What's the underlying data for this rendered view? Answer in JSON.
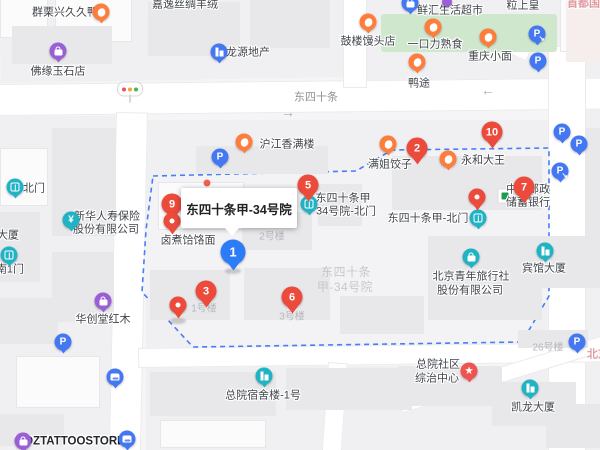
{
  "map": {
    "selected_place": "东四十条甲-34号院",
    "road_label": "东四十条",
    "colors": {
      "boundary": "#4a7cf7",
      "red_pin": "#ec4a3b",
      "blue_pin": "#2d7cf7",
      "teal_marker": "#20b3c4",
      "orange_marker": "#fd7e3c",
      "purple_marker": "#9a5fd5",
      "blue_marker": "#4478f2",
      "postal_green": "#1c9c50",
      "park_green": "#cfe8cd"
    },
    "texts": [
      {
        "t": "群栗兴久久鸭",
        "x": 65,
        "y": 13,
        "c": "poi"
      },
      {
        "t": "嘉逸丝绸羊绒",
        "x": 185,
        "y": 5,
        "c": "poi"
      },
      {
        "t": "佛缘玉石店",
        "x": 58,
        "y": 72,
        "c": "poi"
      },
      {
        "t": "龙源地产",
        "x": 248,
        "y": 53,
        "c": "poi"
      },
      {
        "t": "鲜汇生活超市",
        "x": 450,
        "y": 11,
        "c": "poi"
      },
      {
        "t": "粒上皇",
        "x": 523,
        "y": 6,
        "c": "poi"
      },
      {
        "t": "首都国医",
        "x": 589,
        "y": 4,
        "c": "pink"
      },
      {
        "t": "鼓楼馒头店",
        "x": 368,
        "y": 42,
        "c": "poi"
      },
      {
        "t": "一口力熟食",
        "x": 435,
        "y": 45,
        "c": "poi"
      },
      {
        "t": "重庆小面",
        "x": 490,
        "y": 57,
        "c": "poi"
      },
      {
        "t": "鸭途",
        "x": 419,
        "y": 84,
        "c": "poi"
      },
      {
        "t": "东四十条",
        "x": 316,
        "y": 98,
        "c": "road-name"
      },
      {
        "t": "→",
        "x": 288,
        "y": 112,
        "c": "arrow"
      },
      {
        "t": "←",
        "x": 488,
        "y": 90,
        "c": "arrow"
      },
      {
        "t": "沪江香满楼",
        "x": 287,
        "y": 145,
        "c": "poi"
      },
      {
        "t": "满姐饺子",
        "x": 390,
        "y": 165,
        "c": "poi"
      },
      {
        "t": "永和大王",
        "x": 483,
        "y": 161,
        "c": "poi"
      },
      {
        "t": "中国邮政",
        "x": 528,
        "y": 190,
        "c": "poi"
      },
      {
        "t": "储蓄银行",
        "x": 528,
        "y": 203,
        "c": "poi"
      },
      {
        "t": "东四十条甲",
        "x": 343,
        "y": 199,
        "c": "poi"
      },
      {
        "t": "34号院-北门",
        "x": 346,
        "y": 212,
        "c": "poi"
      },
      {
        "t": "东四十条甲-北门",
        "x": 428,
        "y": 219,
        "c": "poi"
      },
      {
        "t": "北门",
        "x": 34,
        "y": 189,
        "c": "poi"
      },
      {
        "t": "新华人寿保险",
        "x": 107,
        "y": 217,
        "c": "poi"
      },
      {
        "t": "股份有限公司",
        "x": 106,
        "y": 230,
        "c": "poi"
      },
      {
        "t": "大厦",
        "x": 8,
        "y": 236,
        "c": "poi"
      },
      {
        "t": "南1门",
        "x": 10,
        "y": 270,
        "c": "poi"
      },
      {
        "t": "卤煮饸饹面",
        "x": 188,
        "y": 241,
        "c": "poi"
      },
      {
        "t": "2号楼",
        "x": 272,
        "y": 237,
        "c": "bldg"
      },
      {
        "t": "东四十条",
        "x": 346,
        "y": 273,
        "c": "area"
      },
      {
        "t": "甲-34号院",
        "x": 345,
        "y": 288,
        "c": "area"
      },
      {
        "t": "1号楼",
        "x": 204,
        "y": 309,
        "c": "bldg"
      },
      {
        "t": "3号楼",
        "x": 292,
        "y": 317,
        "c": "bldg"
      },
      {
        "t": "北京青年旅行社",
        "x": 471,
        "y": 277,
        "c": "poi"
      },
      {
        "t": "股份有限公司",
        "x": 470,
        "y": 291,
        "c": "poi"
      },
      {
        "t": "宾馆大厦",
        "x": 544,
        "y": 269,
        "c": "poi"
      },
      {
        "t": "26号楼",
        "x": 548,
        "y": 348,
        "c": "bldg"
      },
      {
        "t": "北京",
        "x": 598,
        "y": 355,
        "c": "pink"
      },
      {
        "t": "华创堂红木",
        "x": 103,
        "y": 320,
        "c": "poi"
      },
      {
        "t": "总院宿舍楼-1号",
        "x": 263,
        "y": 396,
        "c": "poi"
      },
      {
        "t": "总院社区",
        "x": 438,
        "y": 365,
        "c": "poi"
      },
      {
        "t": "综治中心",
        "x": 437,
        "y": 379,
        "c": "poi"
      },
      {
        "t": "凯龙大厦",
        "x": 533,
        "y": 408,
        "c": "poi"
      },
      {
        "t": "MDZTATTOOSTORE",
        "x": 70,
        "y": 442,
        "c": "poi-bold"
      }
    ],
    "markers": [
      {
        "name": "food-marker-qunlixing",
        "type": "food",
        "x": 101,
        "y": 12
      },
      {
        "name": "shopping-marker-foyuan",
        "type": "shopping",
        "x": 58,
        "y": 51
      },
      {
        "name": "traffic-light-marker",
        "type": "traffic",
        "x": 130,
        "y": 89
      },
      {
        "name": "company-marker-longyuan",
        "type": "building-blue",
        "x": 219,
        "y": 52
      },
      {
        "name": "supermarket-marker-xianhui",
        "type": "bag-blue",
        "x": 410,
        "y": 3
      },
      {
        "name": "shopping-marker-top-edge",
        "type": "shopping-small",
        "x": 447,
        "y": 2
      },
      {
        "name": "food-marker-gulou",
        "type": "food",
        "x": 368,
        "y": 22
      },
      {
        "name": "food-marker-yikouli",
        "type": "food",
        "x": 433,
        "y": 27
      },
      {
        "name": "food-marker-chongqing",
        "type": "food",
        "x": 488,
        "y": 37
      },
      {
        "name": "food-marker-yatu",
        "type": "food",
        "x": 417,
        "y": 62
      },
      {
        "name": "parking-entrance-marker-1",
        "type": "parking-entrance",
        "x": 537,
        "y": 34
      },
      {
        "name": "parking-marker-1",
        "type": "parking",
        "x": 538,
        "y": 61
      },
      {
        "name": "food-marker-hujiang",
        "type": "food",
        "x": 244,
        "y": 142
      },
      {
        "name": "parking-marker-2",
        "type": "parking",
        "x": 220,
        "y": 157
      },
      {
        "name": "result-pin-2",
        "type": "red-pin",
        "n": "2",
        "x": 417,
        "y": 148
      },
      {
        "name": "food-marker-manjie",
        "type": "food",
        "x": 388,
        "y": 144
      },
      {
        "name": "food-marker-yonghe",
        "type": "food",
        "x": 448,
        "y": 159
      },
      {
        "name": "result-pin-10",
        "type": "red-pin",
        "n": "10",
        "x": 492,
        "y": 132
      },
      {
        "name": "parking-marker-3",
        "type": "parking",
        "x": 562,
        "y": 132
      },
      {
        "name": "parking-marker-4",
        "type": "parking",
        "x": 579,
        "y": 144
      },
      {
        "name": "parking-entrance-marker-2",
        "type": "parking-entrance",
        "x": 560,
        "y": 171
      },
      {
        "name": "result-pin-7",
        "type": "red-pin",
        "n": "7",
        "x": 524,
        "y": 187
      },
      {
        "name": "postal-bank-logo-marker",
        "type": "postal-bank",
        "x": 505,
        "y": 196
      },
      {
        "name": "result-pin-5",
        "type": "red-pin",
        "n": "5",
        "x": 308,
        "y": 185
      },
      {
        "name": "gate-marker-34-north",
        "type": "gate",
        "x": 309,
        "y": 204
      },
      {
        "name": "location-pin-north-gate",
        "type": "red-dot-pin",
        "x": 477,
        "y": 197
      },
      {
        "name": "gate-marker-north",
        "type": "gate",
        "x": 478,
        "y": 218
      },
      {
        "name": "result-pin-9",
        "type": "red-pin",
        "n": "9",
        "x": 172,
        "y": 204
      },
      {
        "name": "location-pin-luzhu",
        "type": "red-dot-pin",
        "x": 172,
        "y": 221
      },
      {
        "name": "poi-dot-marker",
        "type": "small-dot",
        "x": 207,
        "y": 183
      },
      {
        "name": "selected-pin-1",
        "type": "blue-pin",
        "n": "1",
        "x": 233,
        "y": 252
      },
      {
        "name": "gate-marker-beimen-west",
        "type": "gate",
        "x": 15,
        "y": 187
      },
      {
        "name": "insurance-marker-xinhua",
        "type": "insurance",
        "x": 71,
        "y": 220
      },
      {
        "name": "gate-marker-nan1men",
        "type": "gate",
        "x": 9,
        "y": 255
      },
      {
        "name": "company-marker-cyts",
        "type": "briefcase",
        "x": 471,
        "y": 257
      },
      {
        "name": "building-marker-binguan",
        "type": "building-teal",
        "x": 545,
        "y": 251
      },
      {
        "name": "parking-marker-5",
        "type": "parking",
        "x": 577,
        "y": 342
      },
      {
        "name": "shopping-marker-huachuang",
        "type": "shopping",
        "x": 103,
        "y": 301
      },
      {
        "name": "parking-marker-6",
        "type": "parking",
        "x": 63,
        "y": 342
      },
      {
        "name": "bus-marker-1",
        "type": "bus",
        "x": 115,
        "y": 377
      },
      {
        "name": "building-marker-zongyuan",
        "type": "building-teal",
        "x": 264,
        "y": 376
      },
      {
        "name": "star-marker-zongzhi",
        "type": "star",
        "x": 469,
        "y": 371
      },
      {
        "name": "building-marker-kailong",
        "type": "building-teal",
        "x": 530,
        "y": 388
      },
      {
        "name": "shopping-marker-mdzt",
        "type": "shopping",
        "x": 23,
        "y": 441
      },
      {
        "name": "bus-marker-2",
        "type": "bus",
        "x": 127,
        "y": 439
      },
      {
        "name": "location-pin-1haolou",
        "type": "red-dot-pin",
        "x": 178,
        "y": 305
      },
      {
        "name": "result-pin-3",
        "type": "red-pin",
        "n": "3",
        "x": 206,
        "y": 291
      },
      {
        "name": "result-pin-6",
        "type": "red-pin",
        "n": "6",
        "x": 292,
        "y": 297
      }
    ]
  }
}
